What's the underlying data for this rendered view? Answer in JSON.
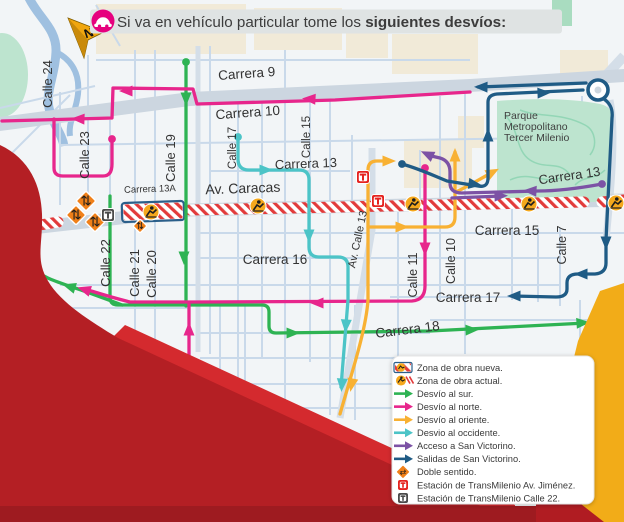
{
  "title": {
    "text_regular": "Si va en vehículo particular tome los ",
    "text_bold": "siguientes desvíos:"
  },
  "compass": {
    "label": "N"
  },
  "park": {
    "name_lines": [
      "Parque",
      "Metropolitano",
      "Tercer Milenio"
    ]
  },
  "street_labels": [
    {
      "text": "Carrera 9",
      "x": 247,
      "y": 78,
      "rot": -4,
      "size": 13.5
    },
    {
      "text": "Carrera 10",
      "x": 248,
      "y": 117,
      "rot": -4,
      "size": 13.5
    },
    {
      "text": "Calle 24",
      "x": 52,
      "y": 84,
      "rot": -90,
      "size": 13
    },
    {
      "text": "Calle 23",
      "x": 89,
      "y": 155,
      "rot": -90,
      "size": 13
    },
    {
      "text": "Calle 19",
      "x": 175,
      "y": 158,
      "rot": -90,
      "size": 13
    },
    {
      "text": "Calle 17",
      "x": 236,
      "y": 148,
      "rot": -90,
      "size": 11.5
    },
    {
      "text": "Calle 15",
      "x": 310,
      "y": 137,
      "rot": -90,
      "size": 11.5
    },
    {
      "text": "Carrera 13",
      "x": 306,
      "y": 168,
      "rot": -2,
      "size": 13
    },
    {
      "text": "Av. Caracas",
      "x": 243,
      "y": 193,
      "rot": -2,
      "size": 14
    },
    {
      "text": "Carrera 13A",
      "x": 150,
      "y": 192,
      "rot": -2,
      "size": 9.5
    },
    {
      "text": "Calle 22",
      "x": 110,
      "y": 263,
      "rot": -90,
      "size": 13
    },
    {
      "text": "Calle 21",
      "x": 139,
      "y": 273,
      "rot": -90,
      "size": 13
    },
    {
      "text": "Calle 20",
      "x": 156,
      "y": 274,
      "rot": -90,
      "size": 13
    },
    {
      "text": "Av. Calle 13",
      "x": 361,
      "y": 240,
      "rot": -78,
      "size": 11
    },
    {
      "text": "Carrera 16",
      "x": 275,
      "y": 264,
      "rot": 0,
      "size": 13.5
    },
    {
      "text": "Calle 11",
      "x": 417,
      "y": 275,
      "rot": -90,
      "size": 12.5
    },
    {
      "text": "Calle 10",
      "x": 455,
      "y": 261,
      "rot": -90,
      "size": 12.5
    },
    {
      "text": "Carrera 15",
      "x": 507,
      "y": 235,
      "rot": 0,
      "size": 13.5
    },
    {
      "text": "Calle 7",
      "x": 566,
      "y": 245,
      "rot": -90,
      "size": 12.5
    },
    {
      "text": "Carrera 17",
      "x": 468,
      "y": 302,
      "rot": 0,
      "size": 13.5
    },
    {
      "text": "Carrera 18",
      "x": 408,
      "y": 334,
      "rot": -7,
      "size": 13.5
    },
    {
      "text": "Carrera 13",
      "x": 570,
      "y": 180,
      "rot": -8,
      "size": 13
    },
    {
      "text": "Calle 6",
      "x": 612,
      "y": 326,
      "rot": -90,
      "size": 12.5
    }
  ],
  "routes": [
    {
      "name": "desvio-al-sur",
      "color": "#2eb353",
      "paths": [
        "M186,62 L186,306",
        "M110,196 L110,297 Q110,305 118,305 L186,305",
        "M122,305 C103,298 88,292 72,287 C55,281 42,277 36,270 C32,264 32,260 33,256",
        "M186,305 L262,305 Q269,305 269,312 L269,326 Q269,333 276,333 L430,331 L586,323"
      ],
      "dots": [
        [
          186,
          62
        ]
      ],
      "arrows": [
        [
          186,
          97,
          90
        ],
        [
          184,
          256,
          90
        ],
        [
          71,
          287,
          197
        ],
        [
          291,
          333,
          0
        ],
        [
          470,
          330,
          -2
        ],
        [
          581,
          323,
          -4
        ]
      ]
    },
    {
      "name": "desvio-al-norte",
      "color": "#e7268c",
      "paths": [
        "M470,92 L335,100 L197,104 L193,89 L113,88 L112,118 L2,121",
        "M112,139 L112,164 Q112,176 103,176 L63,176 Q54,176 54,168 L54,119",
        "M425,168 L425,286 Q425,300 412,301 L196,302 L130,302 C110,297 98,293 88,290",
        "M189,303 L189,360"
      ],
      "dots": [
        [
          112,
          139
        ],
        [
          425,
          168
        ]
      ],
      "arrows": [
        [
          311,
          99,
          183
        ],
        [
          128,
          91,
          180
        ],
        [
          80,
          119,
          182
        ],
        [
          425,
          247,
          90
        ],
        [
          319,
          303,
          180
        ],
        [
          86,
          290,
          197
        ],
        [
          189,
          331,
          270
        ]
      ]
    },
    {
      "name": "desvio-al-oriente",
      "color": "#f8b133",
      "paths": [
        "M340,414 C352,372 366,330 368,300 L368,170 Q368,161 377,161 L390,161",
        "M368,227 L445,227 Q455,227 455,217 L455,152",
        "M458,191 C470,185 480,179 493,172"
      ],
      "dots": [],
      "arrows": [
        [
          387,
          161,
          0
        ],
        [
          352,
          383,
          101
        ],
        [
          400,
          227,
          0
        ],
        [
          455,
          157,
          270
        ],
        [
          491,
          173,
          -28
        ]
      ]
    },
    {
      "name": "desvio-al-occidente",
      "color": "#4cc4c7",
      "paths": [
        "M238,137 L238,159 Q238,170 249,170 L299,170 Q309,170 309,180 L309,247 Q309,257 319,257 L338,257 Q348,257 348,267 L348,300 L341,387"
      ],
      "dots": [
        [
          238,
          137
        ]
      ],
      "arrows": [
        [
          264,
          170,
          0
        ],
        [
          309,
          234,
          90
        ],
        [
          346,
          324,
          94
        ],
        [
          342,
          383,
          94
        ]
      ]
    },
    {
      "name": "acceso-a-san-victorino",
      "color": "#7c52a5",
      "paths": [
        "M602,184 C575,189 552,191 538,191 L462,193 Q450,193 450,183 L450,172 Q450,161 440,158 L427,155",
        "M452,198 L501,196"
      ],
      "dots": [
        [
          602,
          184
        ]
      ],
      "arrows": [
        [
          532,
          191,
          183
        ],
        [
          429,
          155,
          205
        ],
        [
          499,
          196,
          -2
        ]
      ]
    },
    {
      "name": "salidas-de-san-victorino",
      "color": "#1f5b85",
      "paths": [
        "M402,164 C420,169 432,175 447,181 L478,186 Q488,188 488,178 L488,102 Q488,95 497,94 L583,90",
        "M586,83 L478,87",
        "M604,99 C611,104 613,110 612,118 L606,240 L606,263 Q606,273 595,274 L578,274 Q567,274 567,283 L567,289 Q567,297 556,297 L513,296"
      ],
      "dots": [
        [
          402,
          164
        ]
      ],
      "rings": [
        [
          598,
          90,
          10
        ]
      ],
      "arrows": [
        [
          473,
          184,
          8
        ],
        [
          488,
          137,
          270
        ],
        [
          542,
          93,
          -2
        ],
        [
          483,
          87,
          181
        ],
        [
          606,
          241,
          90
        ],
        [
          583,
          274,
          180
        ],
        [
          516,
          296,
          180
        ]
      ]
    }
  ],
  "zones": {
    "hatch_strips": [
      [
        16,
        229,
        58,
        222
      ],
      [
        190,
        210,
        584,
        202
      ],
      [
        602,
        202,
        624,
        200
      ]
    ],
    "obra_box": {
      "x": 122,
      "y": 202,
      "w": 62,
      "h": 19,
      "rot": -2
    },
    "workers": [
      [
        22,
        226
      ],
      [
        151,
        212
      ],
      [
        258,
        206
      ],
      [
        413,
        204
      ],
      [
        529,
        204
      ],
      [
        616,
        203
      ]
    ],
    "diamonds": [
      [
        86,
        201,
        14
      ],
      [
        76,
        215,
        14
      ],
      [
        95,
        222,
        14
      ],
      [
        140,
        226,
        10
      ]
    ]
  },
  "stations": [
    {
      "type": "red",
      "x": 363,
      "y": 177
    },
    {
      "type": "red",
      "x": 378,
      "y": 201
    },
    {
      "type": "dark",
      "x": 108,
      "y": 215
    }
  ],
  "legend": {
    "items": [
      {
        "icon": "obra-nueva-icon",
        "label": "Zona de obra nueva."
      },
      {
        "icon": "obra-actual-icon",
        "label": "Zona de obra actual."
      },
      {
        "icon": "arrow-icon",
        "color": "#2eb353",
        "label": "Desvío al sur."
      },
      {
        "icon": "arrow-icon",
        "color": "#e7268c",
        "label": "Desvío al norte."
      },
      {
        "icon": "arrow-icon",
        "color": "#f8b133",
        "label": "Desvío al oriente."
      },
      {
        "icon": "arrow-icon",
        "color": "#4cc4c7",
        "label": "Desvio al occidente."
      },
      {
        "icon": "arrow-icon",
        "color": "#7c52a5",
        "label": "Acceso a San Victorino."
      },
      {
        "icon": "arrow-icon",
        "color": "#1f5b85",
        "label": "Salidas de San Victorino."
      },
      {
        "icon": "doble-sentido-icon",
        "label": "Doble sentido."
      },
      {
        "icon": "tm-red-icon",
        "label": "Estación de TransMilenio Av. Jiménez."
      },
      {
        "icon": "tm-dark-icon",
        "label": "Estación de TransMilenio Calle 22."
      }
    ]
  },
  "colors": {
    "pink": "#e7268c",
    "green": "#2eb353",
    "yellow": "#f8b133",
    "teal": "#4cc4c7",
    "purple": "#7c52a5",
    "blue": "#1f5b85",
    "station_red": "#e5231f",
    "station_dark": "#4b4b4b",
    "hatch_red": "#e23b3b",
    "obra_border": "#2b5f8a",
    "worker_bg": "#f5a81c",
    "diamond": "#f08019",
    "deco_red": "#b41f24",
    "deco_red_bright": "#d42a2e",
    "deco_red_dark": "#9e1b20",
    "deco_yellow": "#f2ac18",
    "title_bar": "#dfe3e3",
    "car_badge": "#e6007e",
    "compass_gold": "#f0a60f"
  }
}
